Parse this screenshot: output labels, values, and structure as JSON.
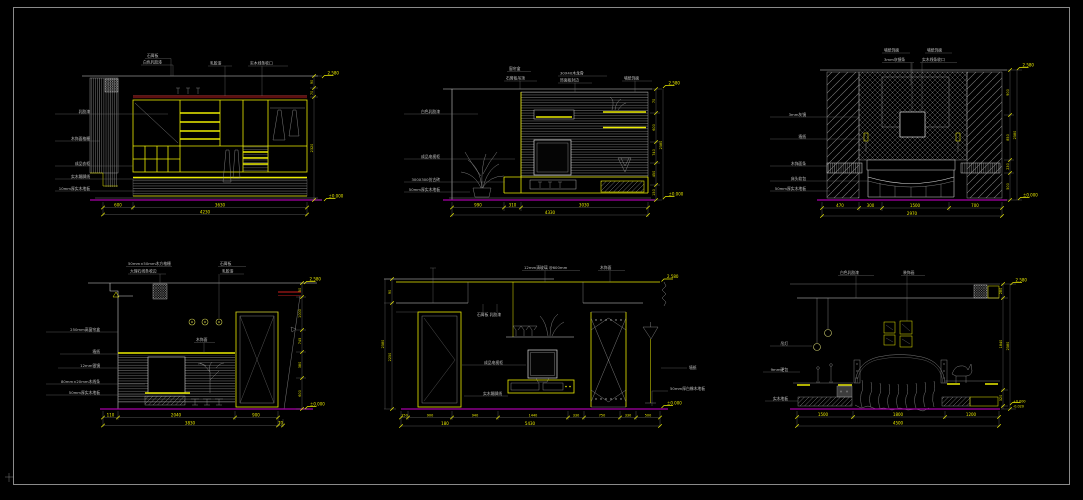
{
  "canvas": {
    "background": "#000000",
    "frame_color": "#8a8a8a"
  },
  "colors": {
    "cad_yellow": "#ecec00",
    "cad_white": "#d9d9d9",
    "cad_gray": "#9b9b9b",
    "floor_magenta": "#a800a8",
    "accent_red": "#8a1414"
  },
  "panels": [
    {
      "id": "wardrobe-elevation",
      "top_labels": [
        "石膏板",
        "白色乳胶漆",
        "乳胶漆",
        "实木线条收口"
      ],
      "left_labels": [
        "乳胶漆",
        "木饰面格栅",
        "成品衣柜",
        "实木踢脚线",
        "10mm厚实木地板"
      ],
      "dims_bottom": [
        "600",
        "3630"
      ],
      "dims_total": "4230",
      "dims_right": [
        "90",
        "70",
        "2320"
      ],
      "marker_top": "2.580",
      "marker_bottom": "±0.000"
    },
    {
      "id": "tv-wall-elevation",
      "top_labels": [
        "窗帘盒",
        "石膏板吊顶",
        "30X40木龙骨",
        "饰面板封边",
        "墙纸饰面"
      ],
      "left_labels": [
        "白色乳胶漆",
        "成品电视柜",
        "300X300仿古砖",
        "50mm厚实木地板"
      ],
      "dims_bottom": [
        "990",
        "310",
        "3030"
      ],
      "dims_total": "4330",
      "dims_right": [
        "70",
        "600",
        "740",
        "450",
        "150"
      ],
      "dims_right_total": "2580",
      "marker_top": "2.580",
      "marker_bottom": "±0.000"
    },
    {
      "id": "bedhead-wall-elevation",
      "top_labels": [
        "墙纸饰面",
        "3mm灰镜条",
        "墙纸饰面",
        "实木线条收口"
      ],
      "left_labels": [
        "3mm灰镜",
        "墙纸",
        "木饰面条",
        "床头软包",
        "50mm厚实木地板"
      ],
      "dims_bottom": [
        "470",
        "300",
        "1500",
        "700"
      ],
      "dims_total": "2970",
      "dims_right": [
        "900",
        "850",
        "230",
        "500"
      ],
      "dims_right_total": "2580",
      "marker_top": "2.580",
      "marker_bottom": "±0.000"
    },
    {
      "id": "dresser-wall-elevation",
      "top_labels": [
        "50mm×50mm木方格栅",
        "大理石线条收边",
        "石膏板",
        "乳胶漆"
      ],
      "mid_label": "木饰面",
      "left_labels": [
        "250mm高窗帘盒",
        "墙纸",
        "12mm银镜",
        "80mm×20mm木线条",
        "50mm厚实木地板"
      ],
      "dims_bottom": [
        "110",
        "2040",
        "900"
      ],
      "dims_tier2": [
        "3830",
        "70"
      ],
      "dims_right": [
        "50",
        "1000",
        "745",
        "380",
        "600"
      ],
      "marker_top": "2.580",
      "marker_bottom": "±0.000"
    },
    {
      "id": "living-tv-wall-elevation",
      "top_labels": [
        "12mm清玻璃 @600mm",
        "木饰面"
      ],
      "mid_labels": [
        "石膏板 乳胶漆",
        "成品电视柜",
        "实木踢脚线"
      ],
      "right_labels": [
        "墙纸",
        "50mm厚白橡木地板"
      ],
      "dims_left": [
        "90",
        "2250"
      ],
      "dims_left_total": "2580",
      "dims_bottom": [
        "150",
        "900",
        "940",
        "1440",
        "330",
        "750",
        "330",
        "500"
      ],
      "dims_tier2": [
        "180",
        "5430"
      ],
      "marker_top": "2.580",
      "marker_bottom": "±0.000"
    },
    {
      "id": "bed-wall-elevation",
      "top_labels": [
        "白色乳胶漆",
        "装饰画"
      ],
      "left_labels": [
        "吊灯",
        "9mm硬包",
        "实木地板"
      ],
      "dims_bottom": [
        "1500",
        "1800",
        "1200"
      ],
      "dims_total": "4500",
      "dims_right": [
        "280",
        "1840",
        "320"
      ],
      "dims_right_total": "2580",
      "marker_top": "2.580",
      "marker_bottom": "±0.000",
      "marker_bottom2": "-0.020"
    }
  ]
}
